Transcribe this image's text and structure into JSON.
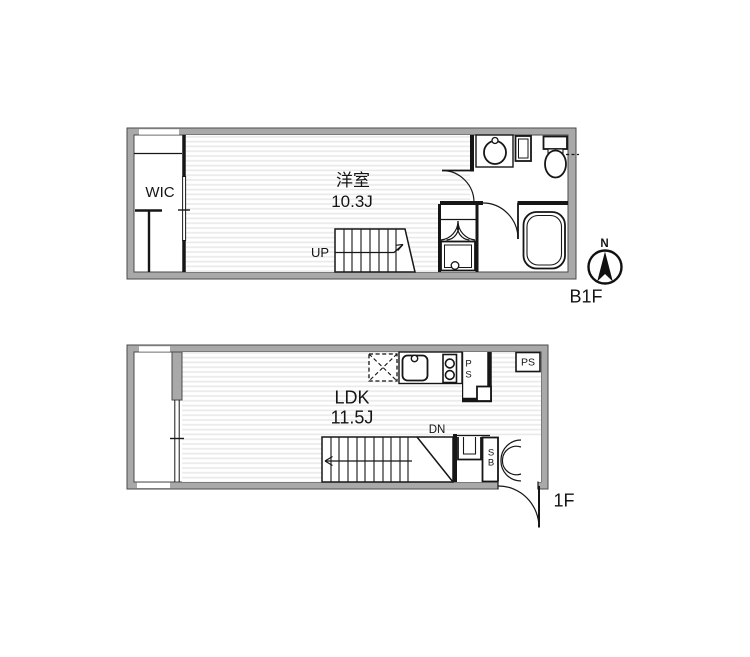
{
  "colors": {
    "wall_fill": "#a9a9a9",
    "wall_edge": "#4a4a4a",
    "line": "#161616",
    "hatch_line": "#e9e9e9",
    "background": "#ffffff"
  },
  "compass": {
    "north_label": "N"
  },
  "b1f": {
    "floor_label": "B1F",
    "closet_label": "WIC",
    "room_label": "洋室",
    "room_size": "10.3J",
    "stairs_label": "UP"
  },
  "f1": {
    "floor_label": "1F",
    "room_label": "LDK",
    "room_size": "11.5J",
    "stairs_label": "DN",
    "pipe_shaft_box_label": "PS",
    "pipe_shaft_vertical_label": "PS",
    "shoe_box_label": "SB"
  }
}
